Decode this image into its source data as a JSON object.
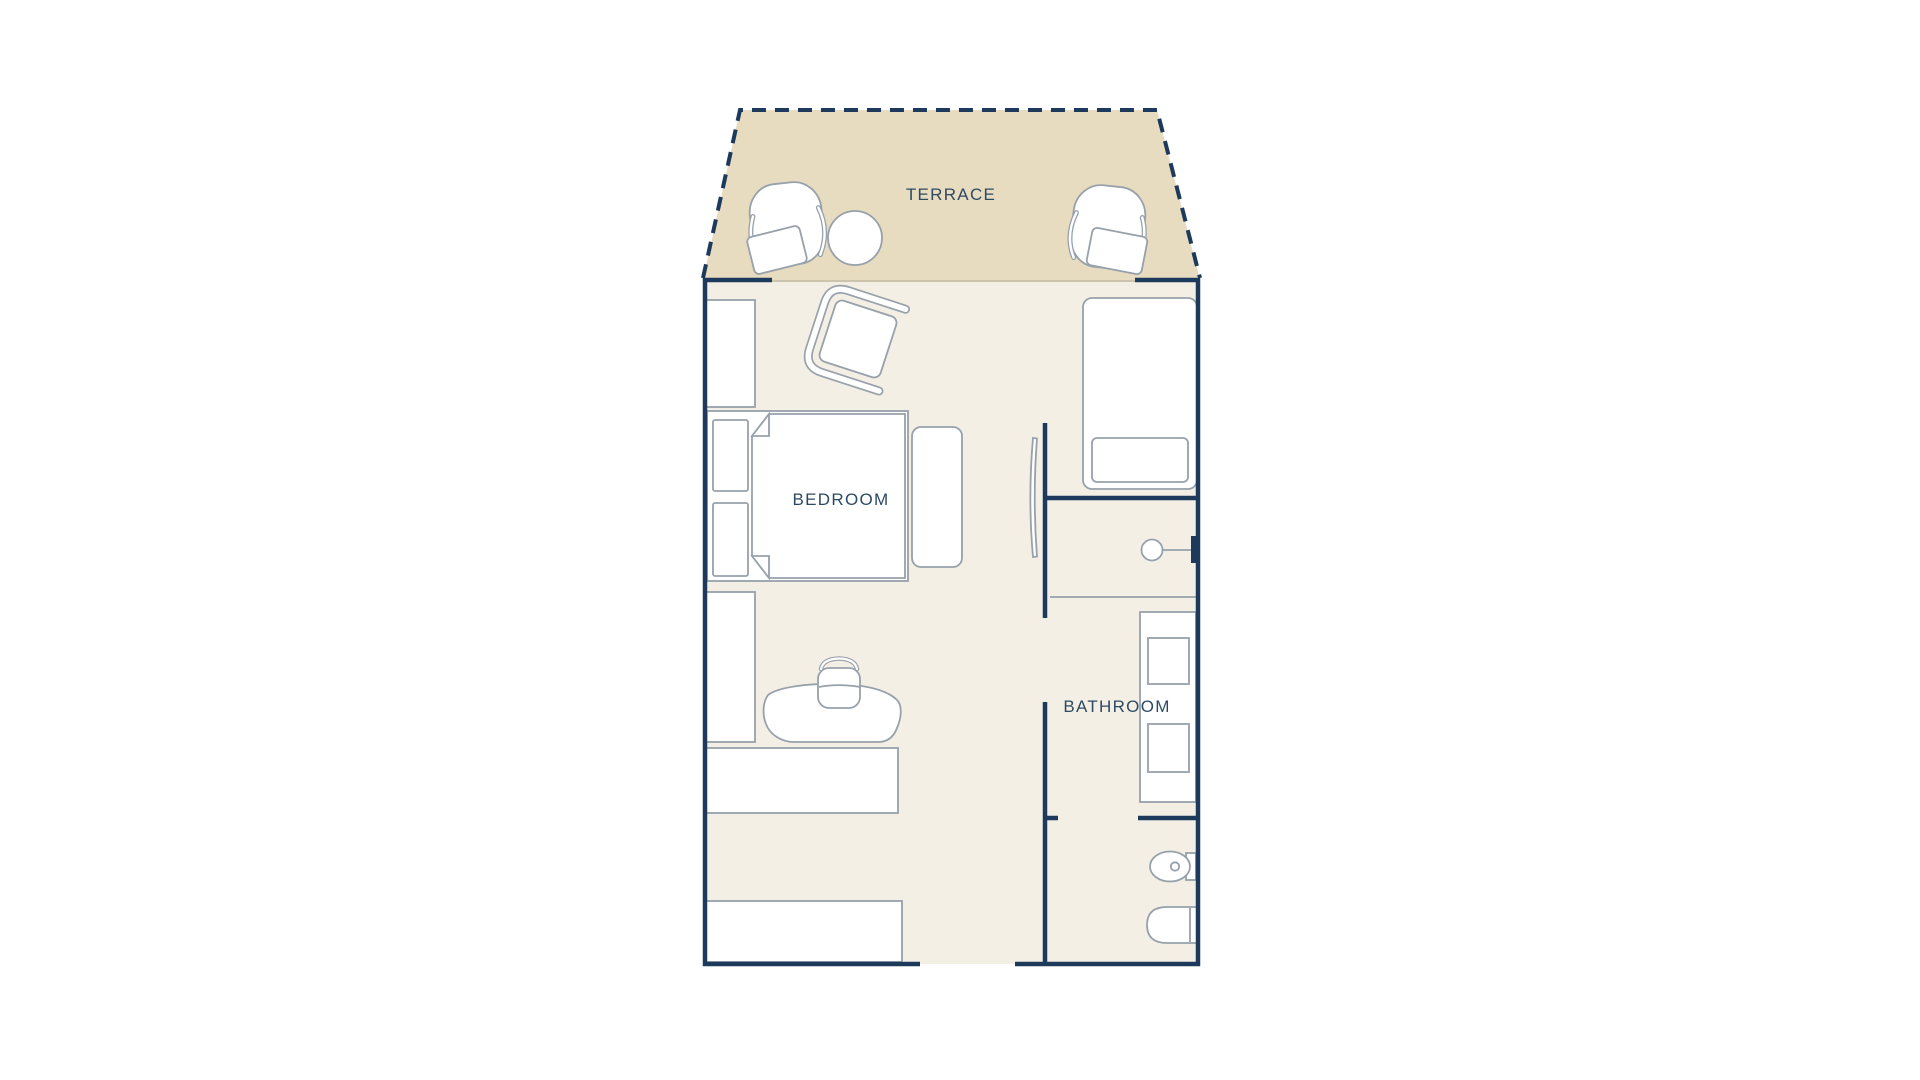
{
  "window": {
    "width_px": 1920,
    "height_px": 1080,
    "background": "#ffffff"
  },
  "floor_plan": {
    "labels": {
      "terrace": "TERRACE",
      "bedroom": "BEDROOM",
      "bathroom": "BATHROOM"
    },
    "colors": {
      "wall": "#1d3a5c",
      "terrace_fill": "#e8dcc0",
      "room_fill": "#f4efe4",
      "furniture_stroke": "#97a1ab",
      "furniture_fill": "#ffffff",
      "label_text": "#2d4a63",
      "window_line": "#ccc4ad"
    }
  }
}
